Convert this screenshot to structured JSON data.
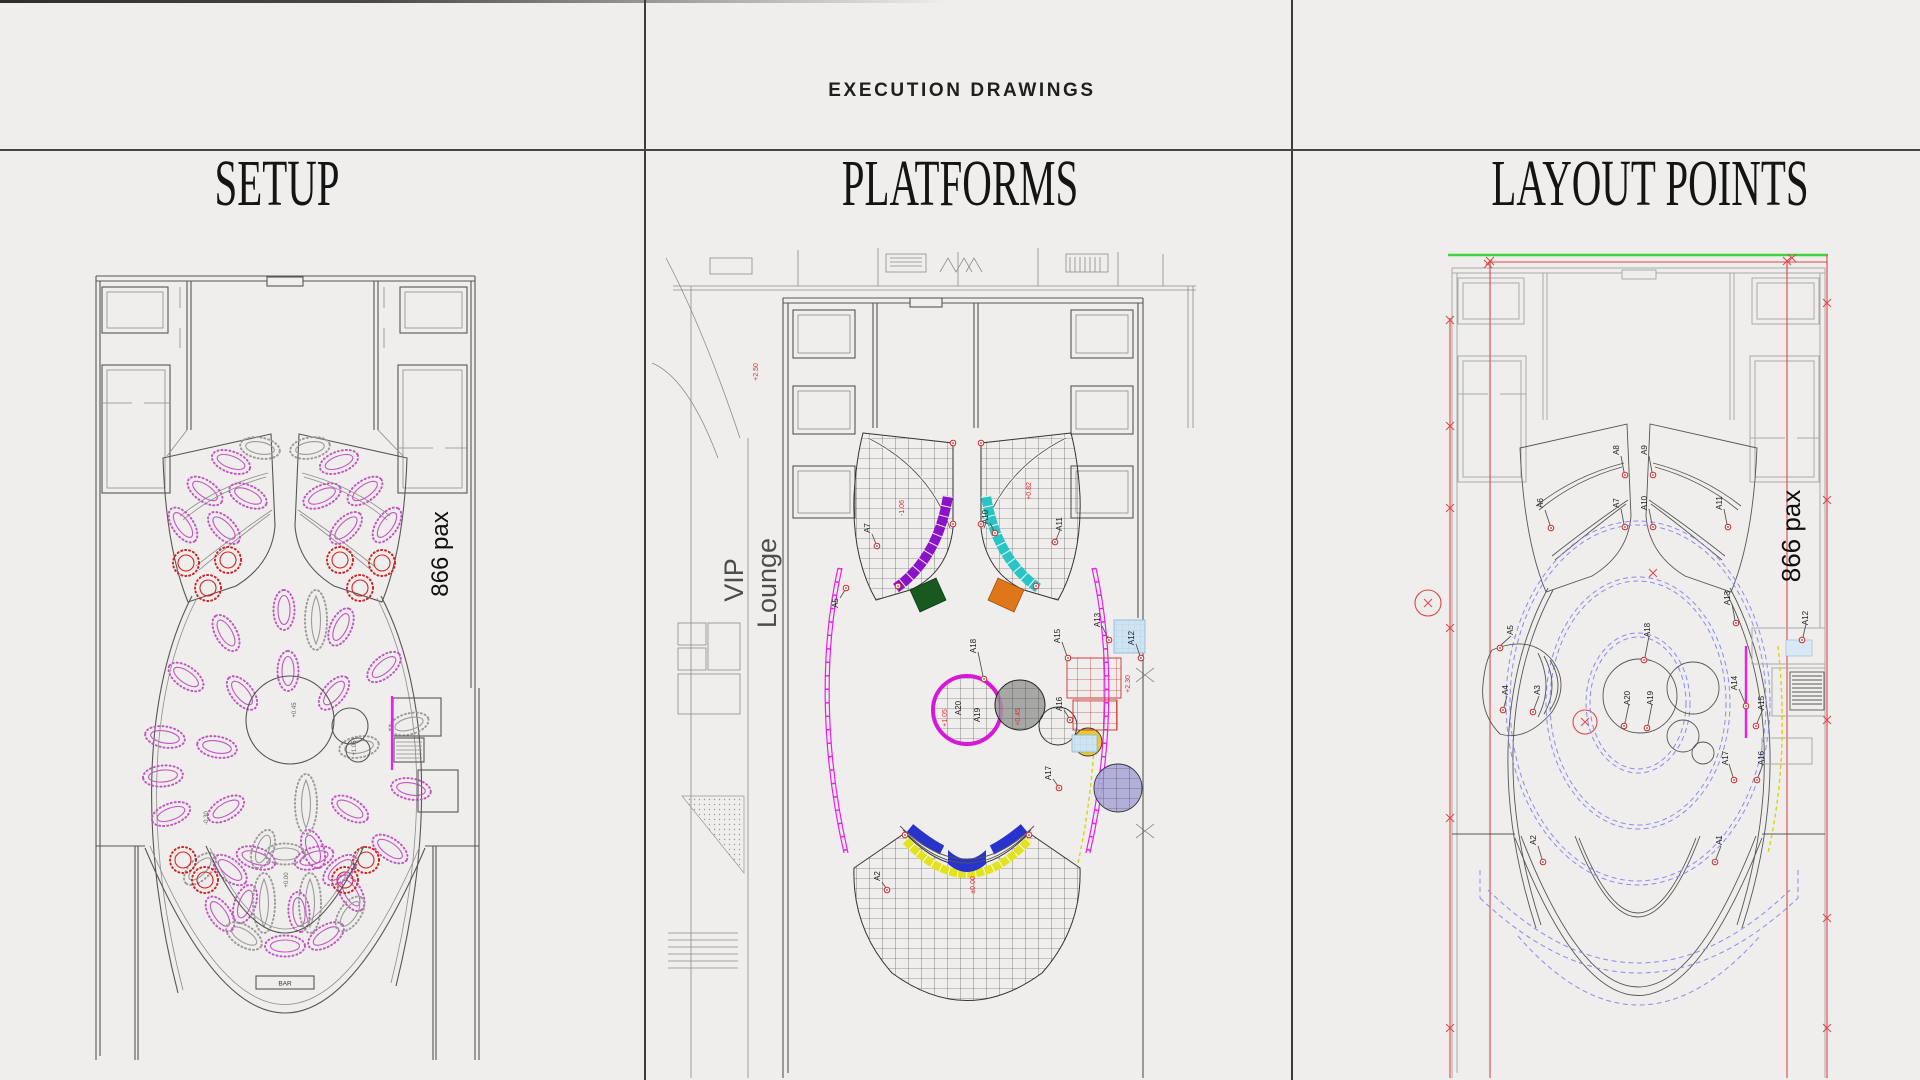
{
  "page": {
    "background": "#efeeec",
    "divider_color": "#3d3d3b"
  },
  "header": {
    "title": "EXECUTION DRAWINGS"
  },
  "setup": {
    "title": "SETUP",
    "capacity": "866 pax",
    "bar": "BAR",
    "levels": [
      "+0.45",
      "+1.05",
      "-0.30",
      "+0.00"
    ]
  },
  "platforms": {
    "title": "PLATFORMS",
    "vip_line1": "VIP",
    "vip_line2": "Lounge",
    "levels": [
      "-1.06",
      "+0.82",
      "+1.05",
      "+0.45",
      "+2.30",
      "±0.00",
      "+2.50"
    ],
    "points": [
      "A5",
      "A7",
      "A11",
      "A13",
      "A15",
      "A18",
      "A12",
      "A16",
      "A17",
      "A19",
      "A20",
      "A2",
      "A10"
    ]
  },
  "layout": {
    "title": "LAYOUT POINTS",
    "capacity": "866 pax",
    "points": [
      "A1",
      "A2",
      "A3",
      "A4",
      "A5",
      "A6",
      "A7",
      "A8",
      "A9",
      "A10",
      "A11",
      "A12",
      "A13",
      "A14",
      "A15",
      "A16",
      "A17",
      "A18",
      "A19",
      "A20"
    ]
  },
  "colors": {
    "table_pink": "#c455c4",
    "table_red": "#d42222",
    "table_gray": "#9b9b9b",
    "platform_purple": "#8a12c8",
    "platform_green": "#17591f",
    "platform_cyan": "#2ac4c4",
    "platform_orange": "#e0761a",
    "platform_magenta": "#ea1fea",
    "platform_yellow": "#dede1c",
    "platform_blue": "#2733cc",
    "platform_red_grid": "#cc4038",
    "platform_lightblue": "#cfe4f2",
    "marker_red": "#e04848",
    "guide_green": "#41d23e",
    "guide_blue_dashed": "#8b8bee"
  }
}
